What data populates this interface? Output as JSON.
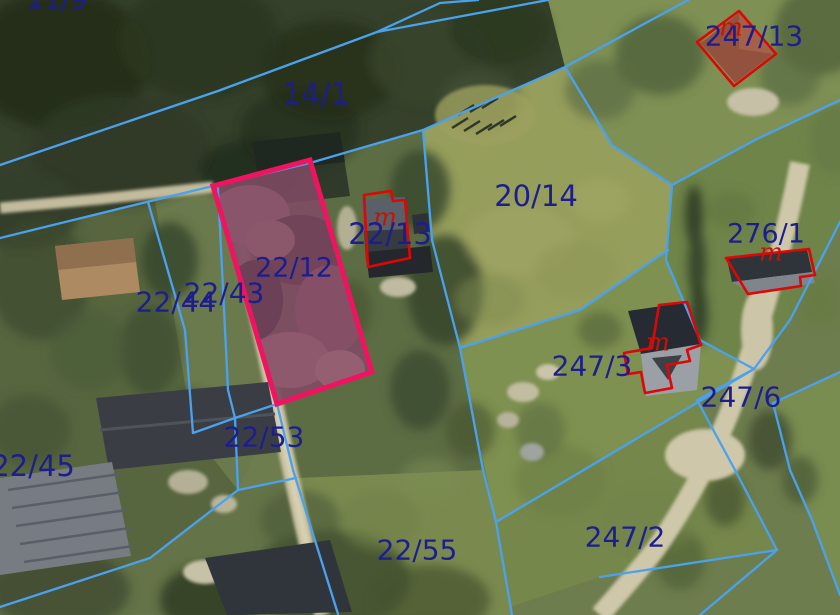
{
  "map": {
    "title": "Cadastral parcel map over aerial imagery",
    "colors": {
      "boundary_blue": "#4aa2ef",
      "label_blue": "#1d1d8f",
      "building_red": "#de0606",
      "highlight_pink": "#f0135f",
      "highlight_fill": "rgba(236,20,110,0.10)"
    },
    "selected_parcel": {
      "id": "22/12",
      "outline": [
        [
          310,
          160
        ],
        [
          372,
          372
        ],
        [
          277,
          404
        ],
        [
          213,
          186
        ]
      ]
    },
    "parcel_labels": [
      {
        "text": "11/9",
        "x": 57,
        "y": 0,
        "fs": 27
      },
      {
        "text": "14/1",
        "x": 316,
        "y": 95,
        "fs": 30
      },
      {
        "text": "247/13",
        "x": 754,
        "y": 36,
        "fs": 28
      },
      {
        "text": "20/14",
        "x": 536,
        "y": 196,
        "fs": 29
      },
      {
        "text": "22/13",
        "x": 390,
        "y": 234,
        "fs": 29
      },
      {
        "text": "276/1",
        "x": 766,
        "y": 234,
        "fs": 27
      },
      {
        "text": "22/12",
        "x": 294,
        "y": 268,
        "fs": 27
      },
      {
        "text": "22/44",
        "x": 176,
        "y": 302,
        "fs": 28
      },
      {
        "text": "22/43",
        "x": 224,
        "y": 293,
        "fs": 28
      },
      {
        "text": "247/3",
        "x": 592,
        "y": 366,
        "fs": 28
      },
      {
        "text": "247/6",
        "x": 741,
        "y": 397,
        "fs": 28
      },
      {
        "text": "22/45",
        "x": 33,
        "y": 466,
        "fs": 29
      },
      {
        "text": "22/53",
        "x": 264,
        "y": 437,
        "fs": 28
      },
      {
        "text": "22/55",
        "x": 417,
        "y": 550,
        "fs": 28
      },
      {
        "text": "247/2",
        "x": 625,
        "y": 537,
        "fs": 28
      }
    ],
    "building_marks": [
      {
        "text": "m",
        "x": 385,
        "y": 217
      },
      {
        "text": "m",
        "x": 731,
        "y": 27
      },
      {
        "text": "m",
        "x": 771,
        "y": 252
      },
      {
        "text": "m",
        "x": 658,
        "y": 342
      }
    ],
    "parcel_lines": [
      [
        [
          0,
          165
        ],
        [
          218,
          91
        ],
        [
          377,
          32
        ],
        [
          548,
          0
        ]
      ],
      [
        [
          377,
          32
        ],
        [
          440,
          3
        ],
        [
          478,
          0
        ]
      ],
      [
        [
          688,
          0
        ],
        [
          565,
          67
        ],
        [
          423,
          130
        ],
        [
          310,
          163
        ],
        [
          213,
          186
        ],
        [
          155,
          200
        ],
        [
          0,
          238
        ]
      ],
      [
        [
          565,
          67
        ],
        [
          612,
          145
        ],
        [
          672,
          185
        ]
      ],
      [
        [
          672,
          185
        ],
        [
          755,
          140
        ],
        [
          840,
          100
        ]
      ],
      [
        [
          672,
          185
        ],
        [
          666,
          260
        ],
        [
          700,
          340
        ],
        [
          754,
          369
        ]
      ],
      [
        [
          423,
          130
        ],
        [
          432,
          240
        ],
        [
          460,
          348
        ],
        [
          483,
          470
        ],
        [
          496,
          522
        ],
        [
          512,
          615
        ]
      ],
      [
        [
          372,
          372
        ],
        [
          277,
          404
        ],
        [
          235,
          418
        ],
        [
          193,
          433
        ]
      ],
      [
        [
          460,
          348
        ],
        [
          580,
          310
        ],
        [
          668,
          250
        ]
      ],
      [
        [
          496,
          522
        ],
        [
          754,
          369
        ]
      ],
      [
        [
          148,
          202
        ],
        [
          185,
          330
        ],
        [
          193,
          433
        ]
      ],
      [
        [
          218,
          188
        ],
        [
          228,
          390
        ],
        [
          235,
          418
        ]
      ],
      [
        [
          235,
          418
        ],
        [
          238,
          490
        ]
      ],
      [
        [
          238,
          490
        ],
        [
          296,
          478
        ]
      ],
      [
        [
          238,
          490
        ],
        [
          150,
          558
        ],
        [
          0,
          607
        ]
      ],
      [
        [
          277,
          404
        ],
        [
          293,
          470
        ],
        [
          338,
          614
        ]
      ],
      [
        [
          840,
          222
        ],
        [
          790,
          320
        ],
        [
          754,
          369
        ],
        [
          697,
          400
        ],
        [
          735,
          470
        ],
        [
          777,
          550
        ]
      ],
      [
        [
          777,
          550
        ],
        [
          700,
          615
        ]
      ],
      [
        [
          600,
          577
        ],
        [
          777,
          550
        ]
      ],
      [
        [
          840,
          372
        ],
        [
          773,
          403
        ],
        [
          790,
          470
        ],
        [
          812,
          520
        ],
        [
          840,
          595
        ]
      ]
    ],
    "building_outlines": [
      [
        [
          364,
          195
        ],
        [
          391,
          191
        ],
        [
          393,
          201
        ],
        [
          405,
          200
        ],
        [
          410,
          258
        ],
        [
          368,
          267
        ]
      ],
      [
        [
          739,
          11
        ],
        [
          776,
          54
        ],
        [
          734,
          86
        ],
        [
          697,
          42
        ]
      ],
      [
        [
          726,
          258
        ],
        [
          809,
          249
        ],
        [
          815,
          275
        ],
        [
          800,
          277
        ],
        [
          801,
          286
        ],
        [
          748,
          294
        ]
      ],
      [
        [
          659,
          305
        ],
        [
          687,
          302
        ],
        [
          701,
          345
        ],
        [
          687,
          350
        ],
        [
          690,
          361
        ],
        [
          667,
          365
        ],
        [
          672,
          388
        ],
        [
          645,
          393
        ],
        [
          641,
          372
        ],
        [
          628,
          374
        ],
        [
          624,
          353
        ],
        [
          652,
          348
        ]
      ]
    ]
  }
}
